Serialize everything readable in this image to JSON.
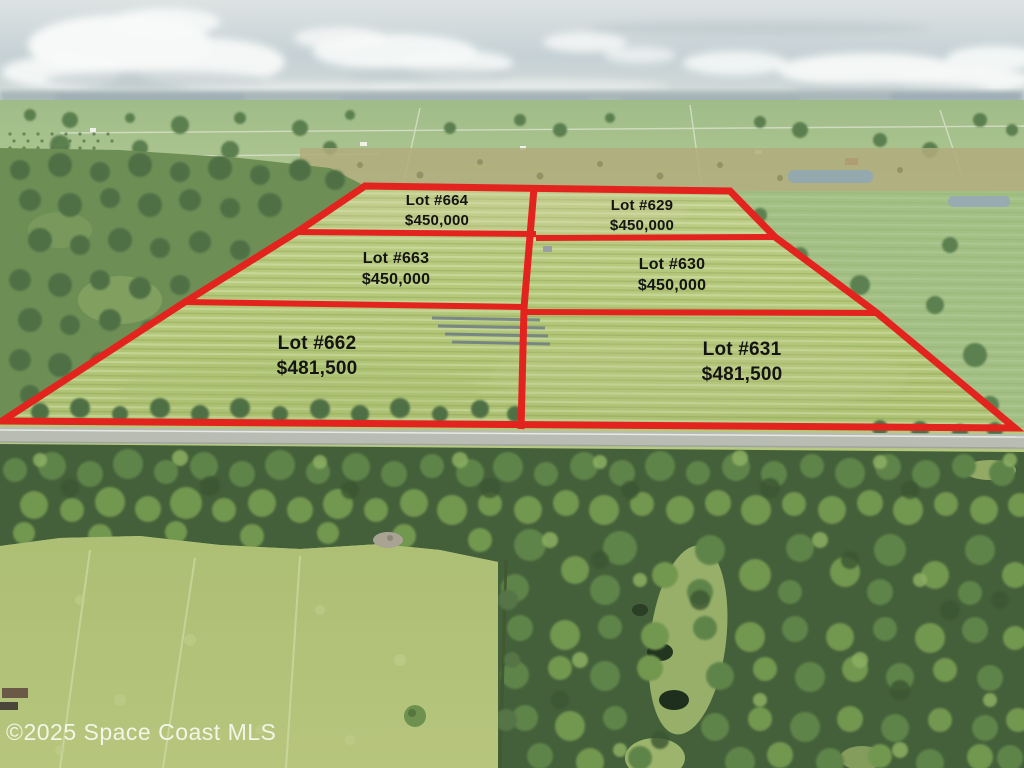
{
  "image_type": "aerial-drone-photo-real-estate-lot-map",
  "watermark": "©2025 Space Coast MLS",
  "lots": [
    {
      "name": "Lot #664",
      "price": "$450,000"
    },
    {
      "name": "Lot #629",
      "price": "$450,000"
    },
    {
      "name": "Lot #663",
      "price": "$450,000"
    },
    {
      "name": "Lot #630",
      "price": "$450,000"
    },
    {
      "name": "Lot #662",
      "price": "$481,500"
    },
    {
      "name": "Lot #631",
      "price": "$481,500"
    }
  ],
  "colors": {
    "boundary_line": "#e3231e",
    "lot_field": "#b6c97e",
    "sky": "#cfd9da",
    "forest": "#4d6c3f",
    "label_text": "#141414",
    "watermark_text": "#f8f8f2"
  }
}
